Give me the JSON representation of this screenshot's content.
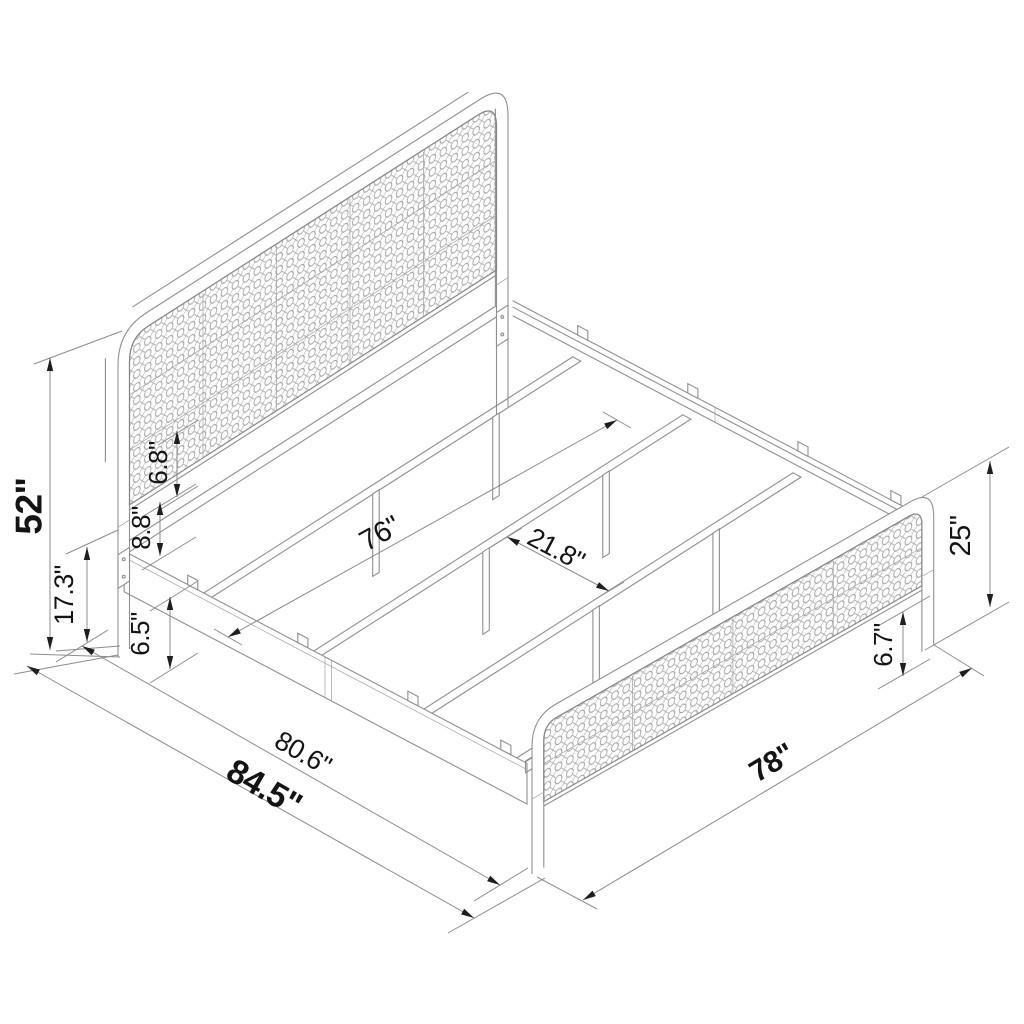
{
  "diagram": {
    "dimensions": {
      "headboard_height": "52\"",
      "rail_height": "17.3\"",
      "panel_gap": "6.8\"",
      "panel_to_rail": "8.8\"",
      "rail_clearance": "6.5\"",
      "inner_width": "76\"",
      "slat_spacing": "21.8\"",
      "footboard_height": "25\"",
      "footboard_clearance": "6.7\"",
      "inner_length": "80.6\"",
      "total_length": "84.5\"",
      "total_width": "78\""
    },
    "colors": {
      "line": "#8f8f8f",
      "annotation": "#1f1f1f",
      "background": "#ffffff"
    }
  }
}
